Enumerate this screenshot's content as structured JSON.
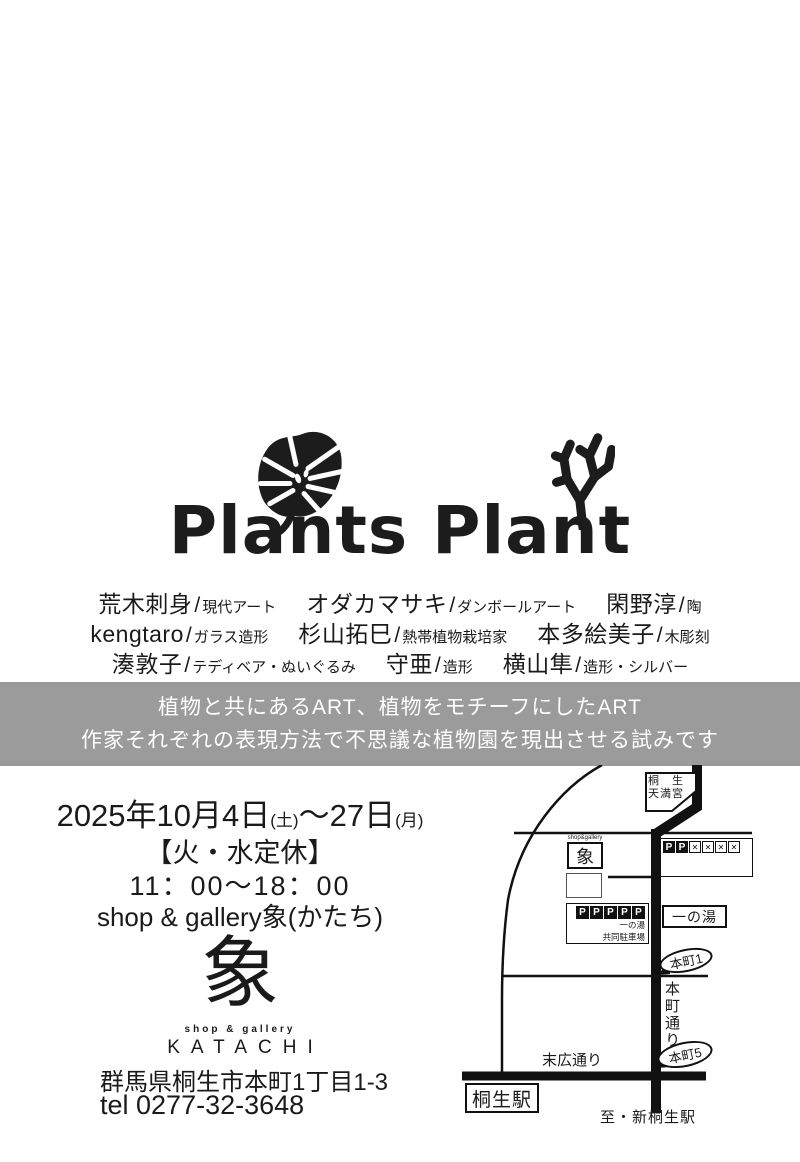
{
  "logo": {
    "title": "Plants Plant"
  },
  "artists": {
    "rows": [
      [
        {
          "name": "荒木刺身",
          "genre": "現代アート"
        },
        {
          "name": "オダカマサキ",
          "genre": "ダンボールアート"
        },
        {
          "name": "閑野淳",
          "genre": "陶"
        }
      ],
      [
        {
          "name": "kengtaro",
          "genre": "ガラス造形"
        },
        {
          "name": "杉山拓巳",
          "genre": "熱帯植物栽培家"
        },
        {
          "name": "本多絵美子",
          "genre": "木彫刻"
        }
      ],
      [
        {
          "name": "湊敦子",
          "genre": "テディベア・ぬいぐるみ"
        },
        {
          "name": "守亜",
          "genre": "造形"
        },
        {
          "name": "横山隼",
          "genre": "造形・シルバー"
        }
      ]
    ],
    "slash": "/"
  },
  "banner": {
    "line1": "植物と共にあるART、植物をモチーフにしたART",
    "line2": "作家それぞれの表現方法で不思議な植物園を現出させる試みです",
    "bg_color": "#9b9b9b",
    "text_color": "#ffffff"
  },
  "info": {
    "date_main": "2025年10月4日",
    "date_day1": "(土)",
    "date_tilde": "～",
    "date_end": "27日",
    "date_day2": "(月)",
    "closed": "【火・水定休】",
    "hours": "11：00～18：00",
    "gallery_line": "shop & gallery象(かたち)",
    "logo_kanji": "象",
    "logo_sub": "shop & gallery",
    "logo_name": "KATACHI",
    "address": "群馬県桐生市本町1丁目1-3",
    "tel": "tel 0277-32-3648"
  },
  "map": {
    "tenmangu_line1": "桐　生",
    "tenmangu_line2": "天満宮",
    "shop_small": "shop&gallery",
    "shop_kanji": "象",
    "p_label": "P",
    "x_label": "✕",
    "parking_name1": "一の湯",
    "parking_name2": "共同駐車場",
    "ichinoyu": "一の湯",
    "honcho1": "本町1",
    "honcho5": "本町5",
    "honcho_dori": "本町通り",
    "suehiro_dori": "末広通り",
    "kiryu_station": "桐生駅",
    "to_station": "至・新桐生駅",
    "ink_color": "#111111"
  }
}
